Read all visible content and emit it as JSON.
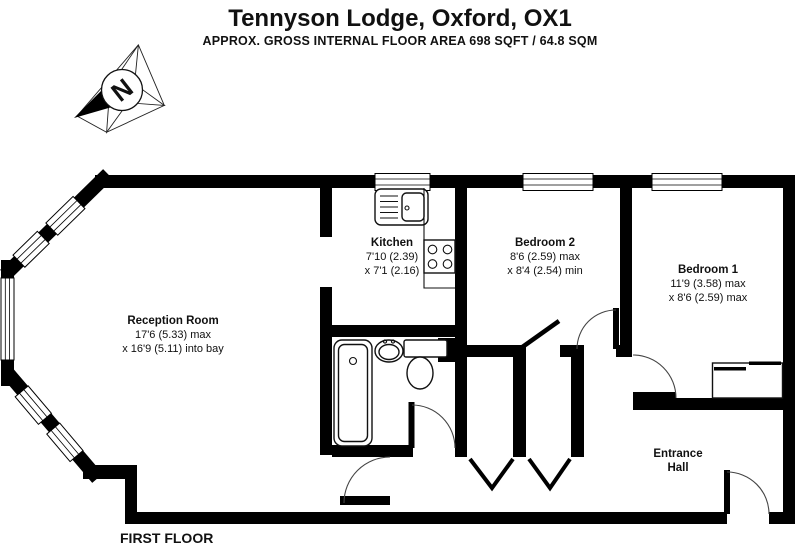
{
  "header": {
    "title": "Tennyson Lodge, Oxford, OX1",
    "subtitle": "APPROX. GROSS INTERNAL FLOOR AREA 698 SQFT / 64.8 SQM"
  },
  "compass": {
    "north_label": "N"
  },
  "rooms": {
    "reception": {
      "name": "Reception Room",
      "dims_line1": "17'6 (5.33) max",
      "dims_line2": "x 16'9 (5.11) into bay"
    },
    "kitchen": {
      "name": "Kitchen",
      "dims_line1": "7'10 (2.39)",
      "dims_line2": "x 7'1 (2.16)"
    },
    "bedroom2": {
      "name": "Bedroom 2",
      "dims_line1": "8'6 (2.59) max",
      "dims_line2": "x 8'4 (2.54) min"
    },
    "bedroom1": {
      "name": "Bedroom 1",
      "dims_line1": "11'9 (3.58) max",
      "dims_line2": "x 8'6 (2.59) max"
    },
    "entrance_hall": {
      "name_line1": "Entrance",
      "name_line2": "Hall"
    }
  },
  "footer": {
    "floor_label": "FIRST FLOOR"
  },
  "colors": {
    "wall": "#000000",
    "background": "#ffffff",
    "text": "#111111"
  },
  "icons": {
    "compass": "north-arrow-icon"
  },
  "fixtures": [
    "bathtub",
    "wash-basin",
    "toilet",
    "kitchen-sink",
    "hob",
    "counter",
    "wardrobe"
  ]
}
